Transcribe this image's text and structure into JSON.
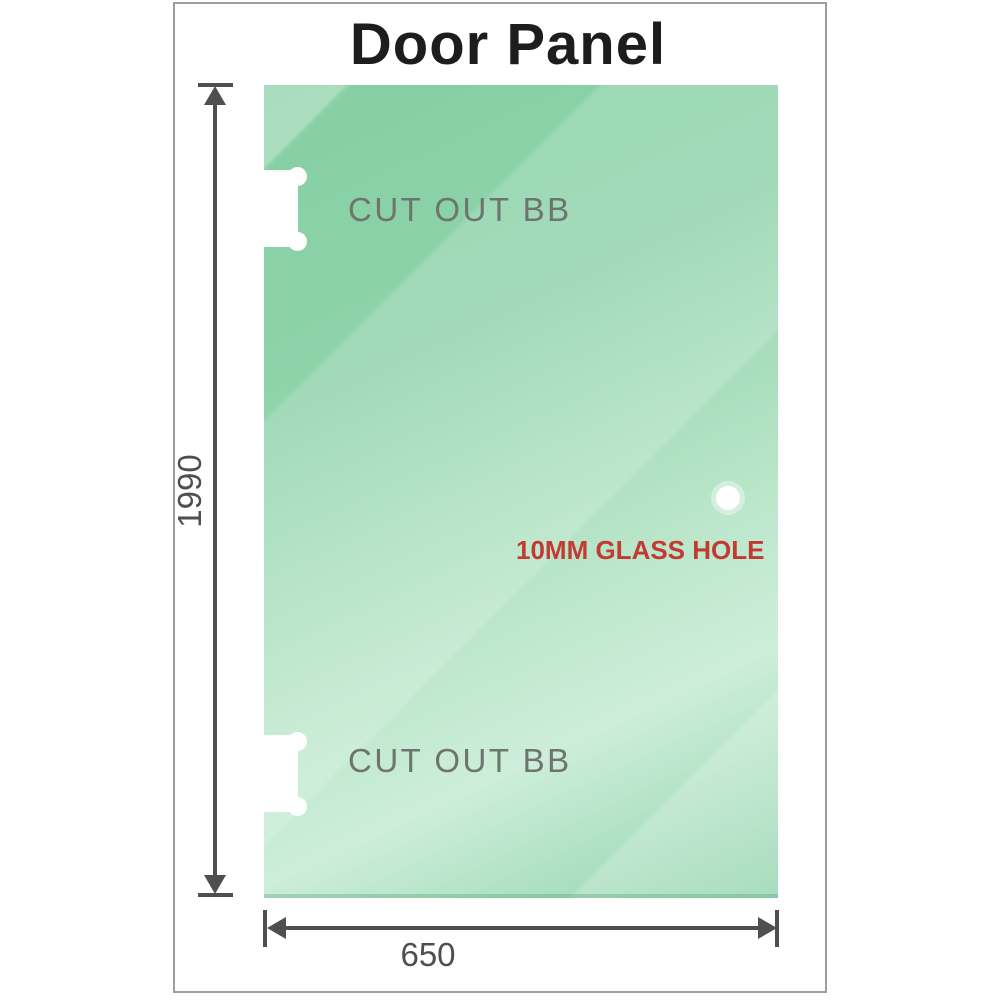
{
  "title": "Door Panel",
  "glass_panel": {
    "cutout_top_label": "CUT OUT BB",
    "cutout_bottom_label": "CUT OUT BB",
    "glass_hole_label": "10MM GLASS HOLE"
  },
  "dimensions": {
    "height": "1990",
    "width": "650"
  },
  "colors": {
    "glass-top": "#84cfa2",
    "glass-mid": "#8fd3ab",
    "glass-light": "#bce7cb",
    "glass-lightest": "#cdeeda",
    "label-gray": "#6e746f",
    "dimension-gray": "#4f4f4f",
    "hole-label-red": "#c23b33",
    "frame-border": "#9e9e9e",
    "title-color": "#1d1d1d"
  }
}
